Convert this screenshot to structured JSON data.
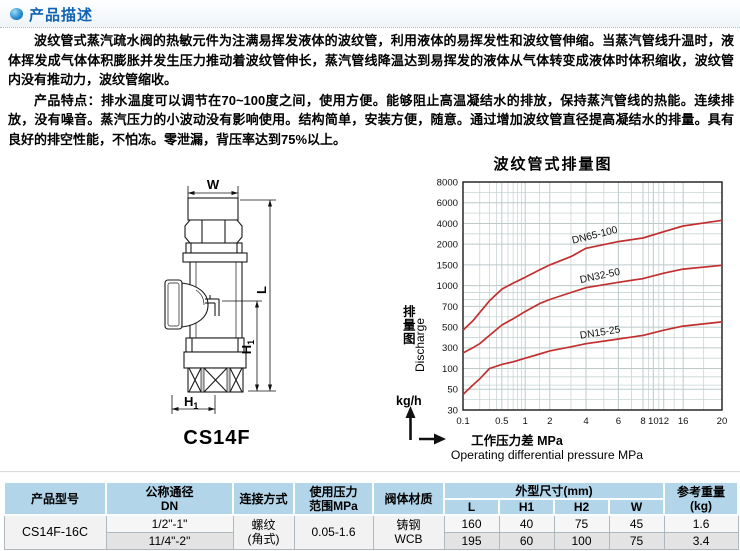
{
  "header": {
    "title": "产品描述"
  },
  "description": {
    "para1": "波纹管式蒸汽疏水阀的热敏元件为注满易挥发液体的波纹管，利用液体的易挥发性和波纹管伸缩。当蒸汽管线升温时，液体挥发成气体体积膨胀并发生压力推动着波纹管伸长，蒸汽管线降温达到易挥发的液体从气体转变成液体时体积缩收，波纹管内没有推动力，波纹管缩收。",
    "para2_label": "产品特点：",
    "para2": "排水温度可以调节在70~100度之间，使用方便。能够阻止高温凝结水的排放，保持蒸汽管线的热能。连续排放，没有噪音。蒸汽压力的小波动没有影响使用。结构简单，安装方便，随意。通过增加波纹管直径提高凝结水的排量。具有良好的排空性能，不怕冻。零泄漏，背压率达到75%以上。"
  },
  "drawing": {
    "caption": "CS14F",
    "dim_w": "W",
    "dim_l": "L",
    "dim_h": "H",
    "dim_h_sub": "1"
  },
  "chart_data": {
    "type": "line",
    "title": "波纹管式排量图",
    "ylabel_cn": "排量图",
    "ylabel_en": "Discharge",
    "y_unit": "kg/h",
    "xlabel_cn": "工作压力差  MPa",
    "xlabel_en": "Operating differential pressure MPa",
    "scale": "log-log (stylized)",
    "xlim": [
      0.1,
      20
    ],
    "ylim": [
      30,
      8000
    ],
    "x_ticks": [
      0.1,
      0.5,
      1,
      2,
      4,
      6,
      8,
      10,
      12,
      16,
      20
    ],
    "x_tick_labels": [
      "0.1",
      "0.5",
      "1",
      "2",
      "4",
      "6",
      "8",
      "10",
      "12",
      "16",
      "20"
    ],
    "y_ticks": [
      8000,
      6000,
      4000,
      2000,
      1500,
      1000,
      700,
      500,
      300,
      100,
      50,
      30
    ],
    "grid": {
      "x_minor": [
        0.2,
        0.3,
        0.4,
        0.6,
        0.7,
        0.8,
        0.9,
        1.5,
        3,
        5,
        7,
        9,
        11,
        14,
        18
      ],
      "y_minor": [
        7000,
        5000,
        3000,
        900,
        800,
        600,
        400,
        200,
        80,
        60,
        40
      ]
    },
    "x": [
      0.1,
      0.15,
      0.2,
      0.3,
      0.5,
      0.7,
      1,
      1.5,
      2,
      3,
      4,
      6,
      8,
      12,
      16,
      20
    ],
    "series": [
      {
        "name": "DN65-100",
        "color": "#c22f2f",
        "values": [
          470,
          560,
          640,
          780,
          950,
          1060,
          1200,
          1380,
          1500,
          1700,
          1900,
          2250,
          2600,
          3200,
          3750,
          4300
        ]
      },
      {
        "name": "DN32-50",
        "color": "#c22f2f",
        "values": [
          250,
          300,
          340,
          420,
          520,
          580,
          650,
          740,
          800,
          900,
          970,
          1080,
          1170,
          1300,
          1400,
          1490
        ]
      },
      {
        "name": "DN15-25",
        "color": "#c22f2f",
        "values": [
          45,
          60,
          75,
          100,
          140,
          165,
          200,
          240,
          270,
          310,
          340,
          385,
          420,
          470,
          510,
          550
        ]
      }
    ]
  },
  "table": {
    "h_model": "产品型号",
    "h_dn1": "公称通径",
    "h_dn2": "DN",
    "h_conn": "连接方式",
    "h_press1": "使用压力",
    "h_press2": "范围MPa",
    "h_body": "阀体材质",
    "h_dims": "外型尺寸(mm)",
    "h_L": "L",
    "h_H1": "H1",
    "h_H2": "H2",
    "h_W": "W",
    "h_weight1": "参考重量",
    "h_weight2": "(kg)",
    "model": "CS14F-16C",
    "conn1": "螺纹",
    "conn2": "(角式)",
    "pressure": "0.05-1.6",
    "body1": "铸钢",
    "body2": "WCB",
    "rows": [
      {
        "dn": "1/2\"-1\"",
        "L": "160",
        "H1": "40",
        "H2": "75",
        "W": "45",
        "weight": "1.6"
      },
      {
        "dn": "11/4\"-2\"",
        "L": "195",
        "H1": "60",
        "H2": "100",
        "W": "75",
        "weight": "3.4"
      }
    ]
  }
}
